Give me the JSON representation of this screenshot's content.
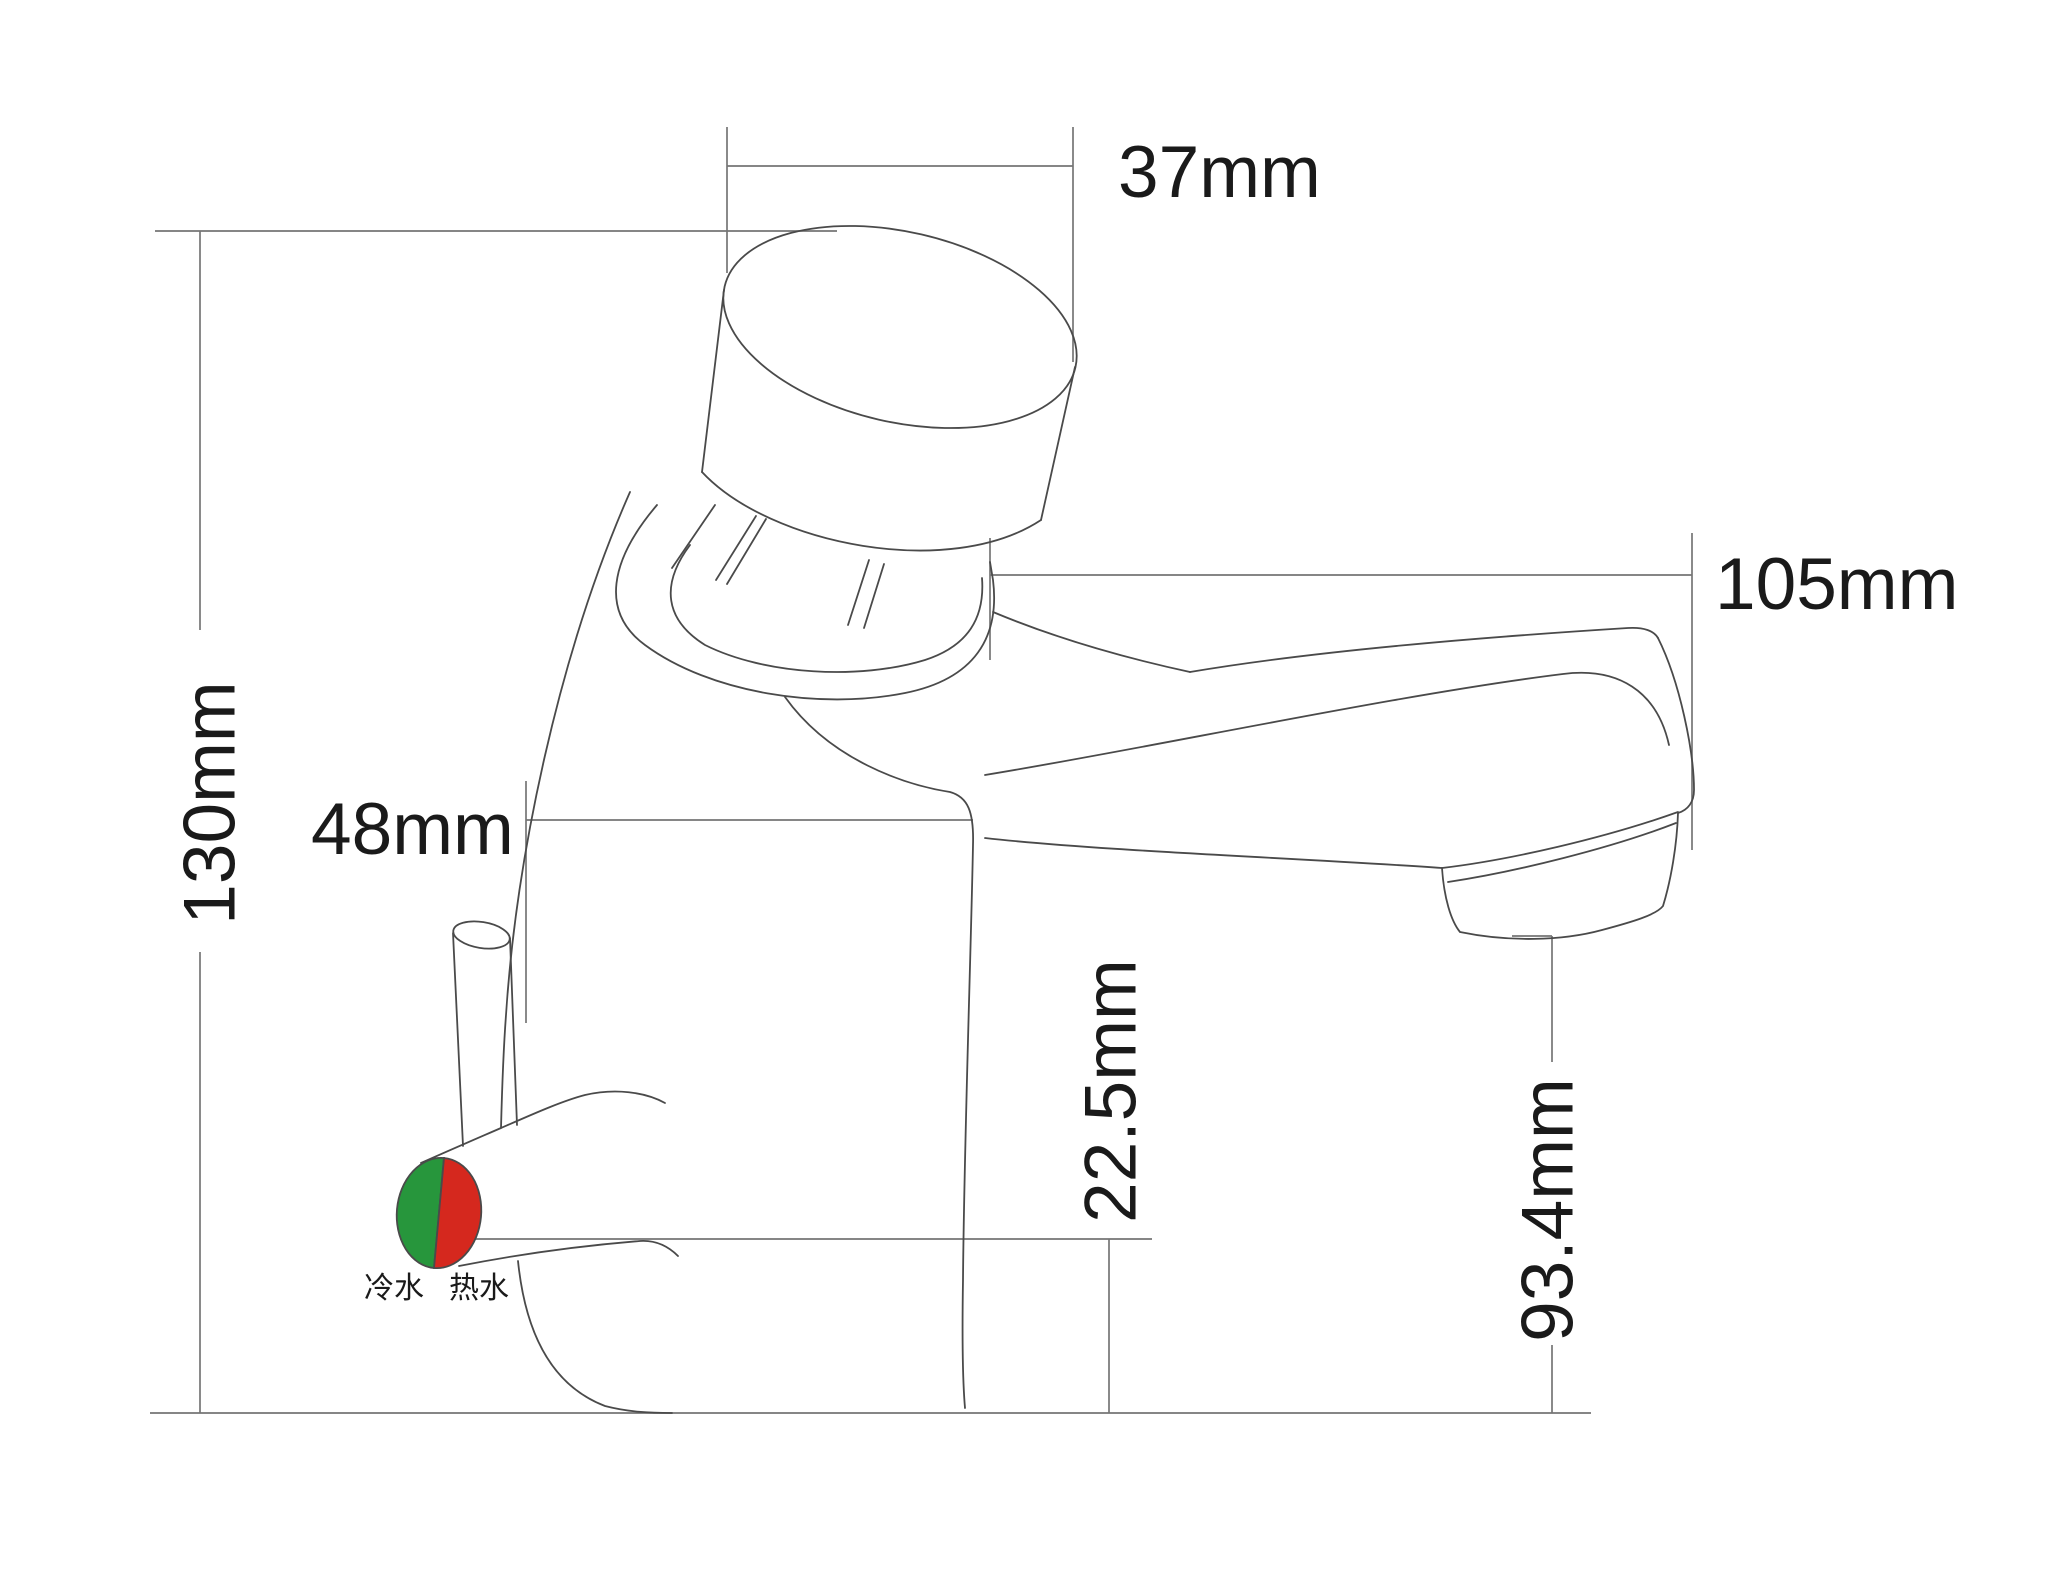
{
  "diagram": {
    "dimensions": {
      "button_width": {
        "label": "37mm",
        "orientation": "horizontal"
      },
      "spout_reach": {
        "label": "105mm",
        "orientation": "horizontal"
      },
      "total_height": {
        "label": "130mm",
        "orientation": "vertical"
      },
      "handle_offset": {
        "label": "48mm",
        "orientation": "horizontal"
      },
      "base_height": {
        "label": "22.5mm",
        "orientation": "vertical"
      },
      "outlet_height": {
        "label": "93.4mm",
        "orientation": "vertical"
      }
    },
    "water_labels": {
      "cold": "冷水",
      "hot": "热水"
    },
    "colors": {
      "cold_green": "#27963c",
      "hot_red": "#d5281e",
      "outline": "#4a4a4a",
      "dimension": "#757575",
      "text": "#1a1a1a",
      "background": "#ffffff"
    }
  }
}
